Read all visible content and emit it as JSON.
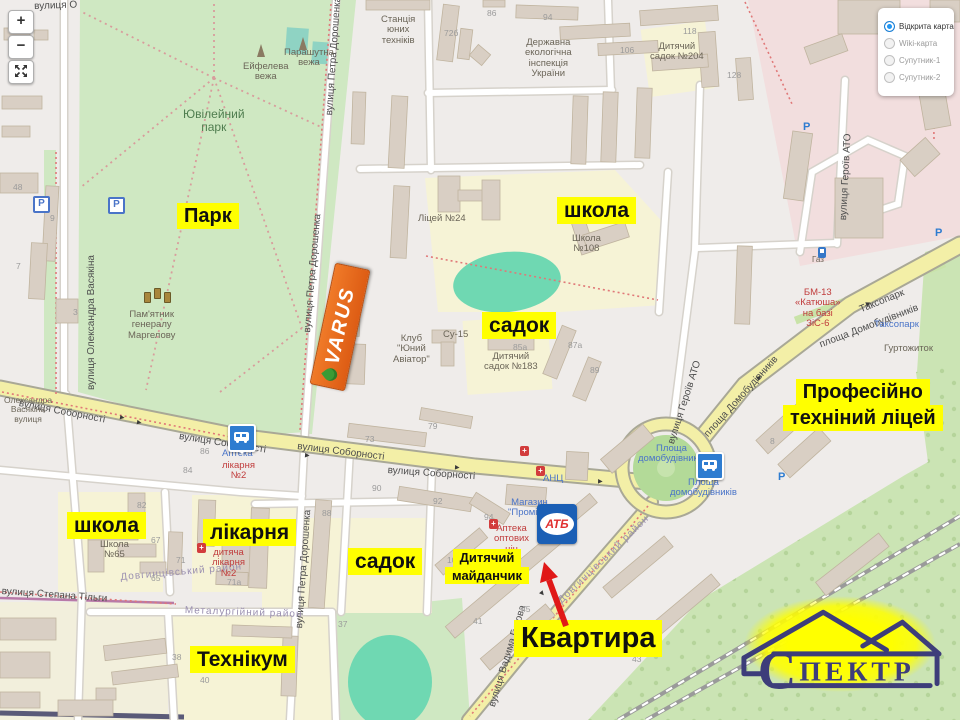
{
  "controls": {
    "zoom_in": "+",
    "zoom_out": "−"
  },
  "layers_panel": {
    "options": [
      {
        "label": "Відкрита карта",
        "selected": true
      },
      {
        "label": "Wiki-карта",
        "selected": false
      },
      {
        "label": "Супутник-1",
        "selected": false
      },
      {
        "label": "Супутник-2",
        "selected": false
      }
    ]
  },
  "logos": {
    "varus": "VARUS",
    "atb": "АТБ",
    "spektr_initial": "С",
    "spektr_rest": "ПЕКТР"
  },
  "annotations": [
    {
      "id": "park",
      "lines": [
        "Парк"
      ],
      "x": 177,
      "y": 203,
      "size": 20
    },
    {
      "id": "school-top",
      "lines": [
        "школа"
      ],
      "x": 557,
      "y": 197,
      "size": 21
    },
    {
      "id": "sadok-top",
      "lines": [
        "садок"
      ],
      "x": 482,
      "y": 312,
      "size": 21
    },
    {
      "id": "lyceum",
      "lines": [
        "Професійно",
        "техніний ліцей"
      ],
      "x": 783,
      "y": 379,
      "size": 20
    },
    {
      "id": "school-left",
      "lines": [
        "школа"
      ],
      "x": 67,
      "y": 512,
      "size": 21
    },
    {
      "id": "hospital",
      "lines": [
        "лікарня"
      ],
      "x": 203,
      "y": 519,
      "size": 21
    },
    {
      "id": "sadok-bottom",
      "lines": [
        "садок"
      ],
      "x": 348,
      "y": 548,
      "size": 21
    },
    {
      "id": "playground",
      "lines": [
        "Дитячий",
        "майданчик"
      ],
      "x": 445,
      "y": 549,
      "size": 13
    },
    {
      "id": "college",
      "lines": [
        "Технікум"
      ],
      "x": 190,
      "y": 646,
      "size": 21
    },
    {
      "id": "apartment",
      "lines": [
        "Квартира"
      ],
      "x": 514,
      "y": 620,
      "size": 29
    }
  ],
  "map_labels": {
    "streets": [
      {
        "t": "вулиця Олександра Васякіна",
        "x": 86,
        "y": 390,
        "rot": -90
      },
      {
        "t": "вулиця Петра Дорошенка",
        "x": 324,
        "y": 115,
        "rot": -86
      },
      {
        "t": "вулиця Петра Дорошенка",
        "x": 302,
        "y": 332,
        "rot": -85
      },
      {
        "t": "вулиця Петра Дорошенка",
        "x": 294,
        "y": 628,
        "rot": -86
      },
      {
        "t": "вулиця Соборності",
        "x": 20,
        "y": 398,
        "rot": 11
      },
      {
        "t": "вулиця Соборності",
        "x": 180,
        "y": 431,
        "rot": 9
      },
      {
        "t": "вулиця Соборності",
        "x": 298,
        "y": 441,
        "rot": 7
      },
      {
        "t": "вулиця Соборності",
        "x": 388,
        "y": 465,
        "rot": 4
      },
      {
        "t": "площа Домобудівників",
        "x": 818,
        "y": 340,
        "rot": -21
      },
      {
        "t": "площа Домобудівників",
        "x": 702,
        "y": 432,
        "rot": -48
      },
      {
        "t": "вулиця Героїв АТО",
        "x": 666,
        "y": 442,
        "rot": -72
      },
      {
        "t": "вулиця Героїв АТО",
        "x": 838,
        "y": 220,
        "rot": -87
      },
      {
        "t": "вулиця Степана Тільги",
        "x": 2,
        "y": 586,
        "rot": 4
      },
      {
        "t": "вулиця Вадима Гурова",
        "x": 487,
        "y": 705,
        "rot": -73
      },
      {
        "t": "Таксопарк",
        "x": 858,
        "y": 305,
        "rot": -22
      },
      {
        "t": "вулиця О",
        "x": 34,
        "y": 1,
        "rot": -2
      },
      {
        "t": "Довгинцівський район",
        "x": 120,
        "y": 572,
        "rot": -5,
        "cls": "district"
      },
      {
        "t": "Довгинцівський район",
        "x": 556,
        "y": 598,
        "rot": -44,
        "cls": "district"
      },
      {
        "t": "Металургійний район",
        "x": 185,
        "y": 605,
        "rot": 2,
        "cls": "district"
      }
    ],
    "pois": [
      {
        "lines": [
          "Станція",
          "юних",
          "техніків"
        ],
        "x": 381,
        "y": 15
      },
      {
        "lines": [
          "Державна",
          "екологічна",
          "інспекція",
          "України"
        ],
        "x": 525,
        "y": 38
      },
      {
        "lines": [
          "Дитячий",
          "садок №204"
        ],
        "x": 650,
        "y": 42
      },
      {
        "lines": [
          "Ліцей №24"
        ],
        "x": 418,
        "y": 214
      },
      {
        "lines": [
          "Школа",
          "№108"
        ],
        "x": 572,
        "y": 234
      },
      {
        "lines": [
          "Клуб",
          "\"Юний",
          "Авіатор\""
        ],
        "x": 393,
        "y": 334
      },
      {
        "lines": [
          "Су-15"
        ],
        "x": 443,
        "y": 330
      },
      {
        "lines": [
          "Дитячий",
          "садок №183"
        ],
        "x": 484,
        "y": 352
      },
      {
        "lines": [
          "Ейфелева",
          "вежа"
        ],
        "x": 243,
        "y": 62
      },
      {
        "lines": [
          "Парашутна",
          "вежа"
        ],
        "x": 284,
        "y": 48
      },
      {
        "lines": [
          "Пам'ятник",
          "генералу",
          "Маргелову"
        ],
        "x": 128,
        "y": 310
      },
      {
        "lines": [
          "Ювілейний",
          "парк"
        ],
        "x": 183,
        "y": 108,
        "cls": "green"
      },
      {
        "lines": [
          "Школа",
          "№65"
        ],
        "x": 100,
        "y": 540
      },
      {
        "lines": [
          "дитяча",
          "лікарня",
          "№2"
        ],
        "x": 212,
        "y": 548,
        "cls": "red"
      },
      {
        "lines": [
          "Аптека"
        ],
        "x": 222,
        "y": 449,
        "cls": "blue"
      },
      {
        "lines": [
          "лікарня",
          "№2"
        ],
        "x": 222,
        "y": 461,
        "cls": "red"
      },
      {
        "lines": [
          "АНЦ"
        ],
        "x": 543,
        "y": 474,
        "cls": "blue"
      },
      {
        "lines": [
          "Магазин",
          "\"Промінь\""
        ],
        "x": 508,
        "y": 498,
        "cls": "blue"
      },
      {
        "lines": [
          "Аптека",
          "оптових",
          "цін"
        ],
        "x": 494,
        "y": 524,
        "cls": "red"
      },
      {
        "lines": [
          "Площа",
          "домобудівників"
        ],
        "x": 638,
        "y": 444,
        "cls": "blue"
      },
      {
        "lines": [
          "Площа",
          "домобудівників"
        ],
        "x": 670,
        "y": 478,
        "cls": "blue"
      },
      {
        "lines": [
          "Таксопарк"
        ],
        "x": 874,
        "y": 320,
        "cls": "blue"
      },
      {
        "lines": [
          "Гуртожиток"
        ],
        "x": 884,
        "y": 344
      },
      {
        "lines": [
          "БМ-13",
          "«Катюша»",
          "на базі",
          "ЗіС-6"
        ],
        "x": 795,
        "y": 288,
        "cls": "red"
      },
      {
        "lines": [
          "Газ"
        ],
        "x": 812,
        "y": 256,
        "size": 8
      },
      {
        "lines": [
          "Олександра",
          "Васякіна",
          "вулиця"
        ],
        "x": 4,
        "y": 396,
        "size": 8.5
      }
    ],
    "numbers": [
      {
        "t": "48",
        "x": 13,
        "y": 183
      },
      {
        "t": "9",
        "x": 50,
        "y": 214
      },
      {
        "t": "7",
        "x": 16,
        "y": 262
      },
      {
        "t": "3",
        "x": 73,
        "y": 308
      },
      {
        "t": "86",
        "x": 487,
        "y": 9
      },
      {
        "t": "94",
        "x": 543,
        "y": 13
      },
      {
        "t": "72б",
        "x": 444,
        "y": 29
      },
      {
        "t": "106",
        "x": 620,
        "y": 46
      },
      {
        "t": "118",
        "x": 683,
        "y": 27
      },
      {
        "t": "128",
        "x": 727,
        "y": 71
      },
      {
        "t": "73",
        "x": 365,
        "y": 435
      },
      {
        "t": "79",
        "x": 428,
        "y": 422
      },
      {
        "t": "90",
        "x": 372,
        "y": 484
      },
      {
        "t": "86",
        "x": 200,
        "y": 447
      },
      {
        "t": "84",
        "x": 183,
        "y": 466
      },
      {
        "t": "88",
        "x": 322,
        "y": 509
      },
      {
        "t": "92",
        "x": 433,
        "y": 497
      },
      {
        "t": "94",
        "x": 484,
        "y": 513
      },
      {
        "t": "100",
        "x": 447,
        "y": 556
      },
      {
        "t": "37",
        "x": 338,
        "y": 620
      },
      {
        "t": "41",
        "x": 473,
        "y": 617
      },
      {
        "t": "45",
        "x": 521,
        "y": 605
      },
      {
        "t": "43",
        "x": 632,
        "y": 655
      },
      {
        "t": "82",
        "x": 137,
        "y": 501
      },
      {
        "t": "67",
        "x": 151,
        "y": 536
      },
      {
        "t": "71",
        "x": 176,
        "y": 556
      },
      {
        "t": "65",
        "x": 151,
        "y": 574
      },
      {
        "t": "71а",
        "x": 227,
        "y": 578
      },
      {
        "t": "38",
        "x": 172,
        "y": 653
      },
      {
        "t": "40",
        "x": 200,
        "y": 676
      },
      {
        "t": "8",
        "x": 770,
        "y": 437
      },
      {
        "t": "85а",
        "x": 513,
        "y": 343
      },
      {
        "t": "87а",
        "x": 568,
        "y": 341
      },
      {
        "t": "89",
        "x": 590,
        "y": 366
      }
    ]
  },
  "icons": [
    {
      "type": "bus",
      "x": 228,
      "y": 424
    },
    {
      "type": "bus",
      "x": 696,
      "y": 452
    },
    {
      "type": "pbox",
      "x": 33,
      "y": 196
    },
    {
      "type": "pbox",
      "x": 108,
      "y": 197
    },
    {
      "type": "p",
      "x": 803,
      "y": 121
    },
    {
      "type": "p",
      "x": 935,
      "y": 227
    },
    {
      "type": "p",
      "x": 778,
      "y": 471
    },
    {
      "type": "rx",
      "x": 520,
      "y": 446
    },
    {
      "type": "rx",
      "x": 536,
      "y": 466
    },
    {
      "type": "rx",
      "x": 489,
      "y": 519
    },
    {
      "type": "rx",
      "x": 197,
      "y": 543
    },
    {
      "type": "fuel",
      "x": 818,
      "y": 247
    },
    {
      "type": "mon",
      "x": 144,
      "y": 292
    },
    {
      "type": "mon",
      "x": 154,
      "y": 288
    },
    {
      "type": "mon",
      "x": 164,
      "y": 292
    },
    {
      "type": "tower",
      "x": 257,
      "y": 44
    },
    {
      "type": "tower",
      "x": 299,
      "y": 37
    },
    {
      "type": "ra",
      "x": 120,
      "y": 414,
      "rot": 10
    },
    {
      "type": "ra",
      "x": 137,
      "y": 419,
      "rot": 10
    },
    {
      "type": "ra",
      "x": 305,
      "y": 452,
      "rot": 5
    },
    {
      "type": "ra",
      "x": 455,
      "y": 464,
      "rot": 4
    },
    {
      "type": "ra",
      "x": 598,
      "y": 478,
      "rot": 2
    },
    {
      "type": "ra",
      "x": 757,
      "y": 374,
      "rot": -38
    },
    {
      "type": "ra",
      "x": 866,
      "y": 300,
      "rot": -25
    },
    {
      "type": "ra",
      "x": 540,
      "y": 590,
      "rot": 50
    }
  ]
}
